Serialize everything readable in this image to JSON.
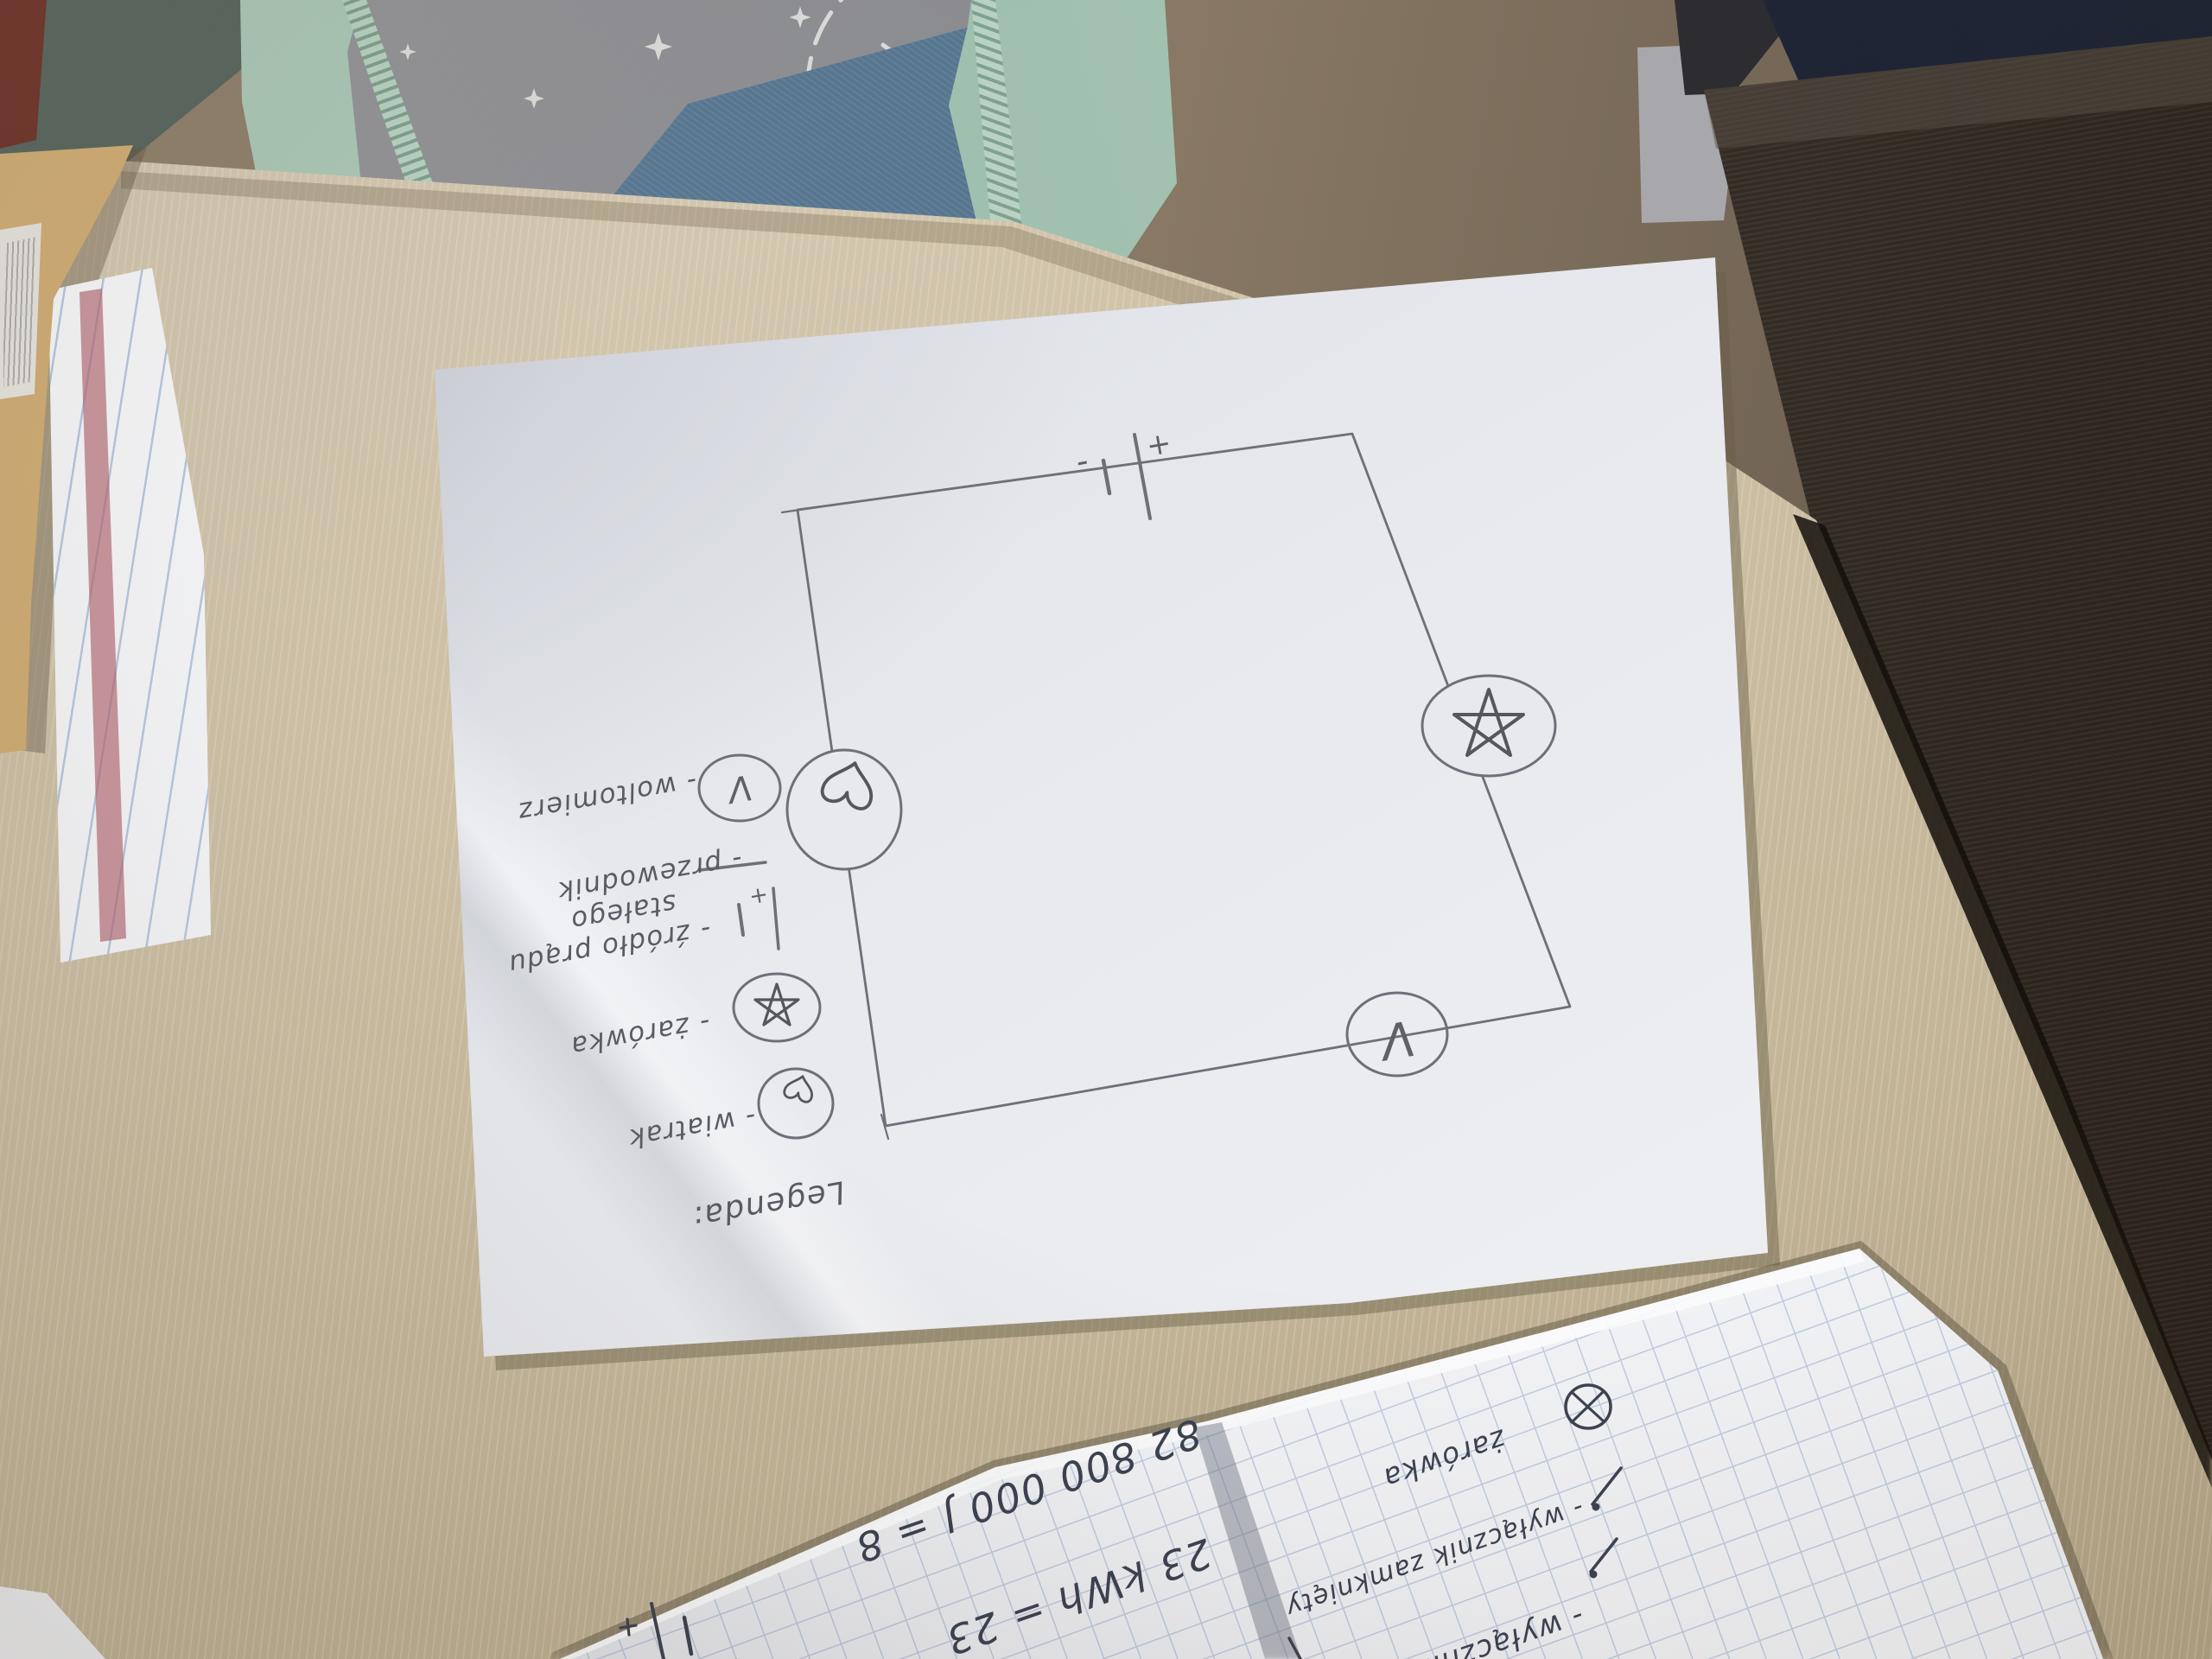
{
  "paper": {
    "legend": {
      "title": "Legenda:",
      "items": [
        {
          "symbol": "voltmeter-circle",
          "symbol_letter": "V",
          "label": "- woltomierz"
        },
        {
          "symbol": "conductor-line",
          "label": "- przewodnik"
        },
        {
          "symbol": "dc-source-battery",
          "plus": "+",
          "label_line1": "- źródło prądu",
          "label_line2": "stałego"
        },
        {
          "symbol": "bulb-star-circle",
          "label": "- żarówka"
        },
        {
          "symbol": "fan-heart-circle",
          "label": "- wiatrak"
        }
      ]
    },
    "circuit": {
      "battery_plus": "+",
      "battery_minus": "-",
      "meter_letter": "V"
    }
  },
  "grid_notebook": {
    "left_page": {
      "line1": "23 kWh = 23",
      "line2": "82 800 000 J = 8"
    },
    "right_page": {
      "bulb_label": "żarówka",
      "switch_line1": "- wyłącznik zamknięty",
      "switch_line2": "- wyłącznik"
    }
  },
  "colors": {
    "desk_wood": "#d3c6ac",
    "dark_table": "#332c24",
    "paper": "#e9eaef",
    "pencil": "#6e6f78",
    "pen": "#3d4250",
    "hoodie_mint": "#a3c2b1",
    "tshirt_grey": "#85868a",
    "jeans_blue": "#54738d",
    "grid_paper": "#f3f4f7",
    "grid_line": "#b5c3dd",
    "ruled_line": "#a9bedb",
    "margin_red": "#b2646e",
    "kraft": "#c7a368",
    "navy_fabric": "#202737"
  }
}
